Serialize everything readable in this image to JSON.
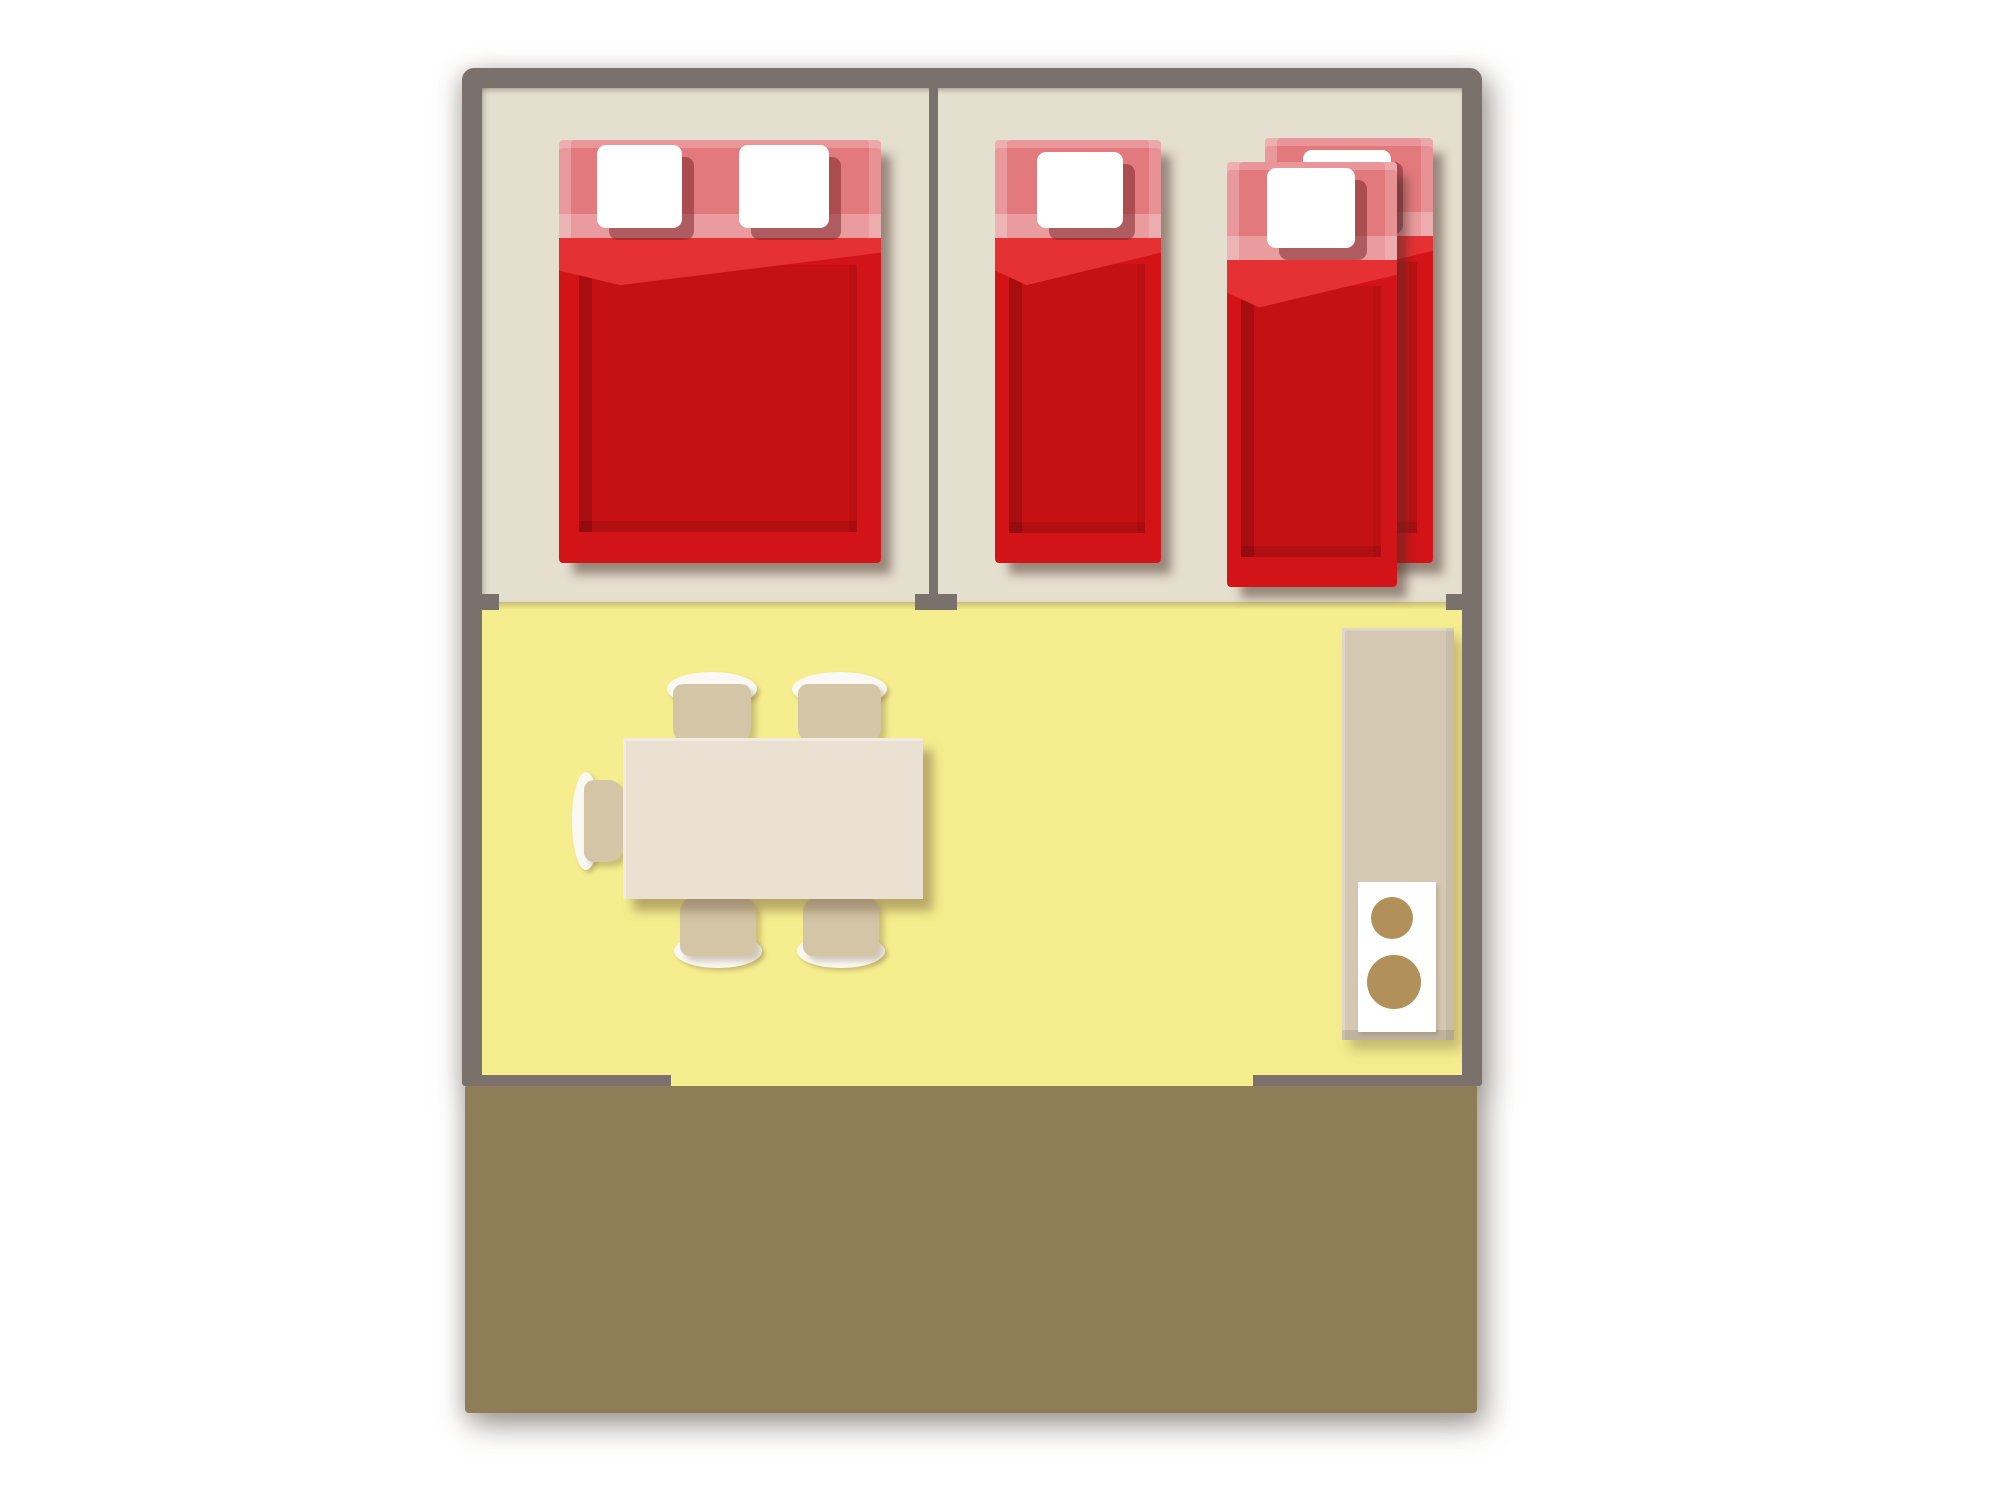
{
  "scene": {
    "type": "floor-plan",
    "description": "Top-down floor plan of a holiday mobile home: two bedrooms (beige floor), open living-dining area (yellow floor) with kitchen unit, and a wooden terrace (brown) at the bottom",
    "rooms": [
      {
        "name": "bedroom-1",
        "floor": "beige",
        "furniture": [
          "double-bed"
        ]
      },
      {
        "name": "bedroom-2",
        "floor": "beige",
        "furniture": [
          "single-bed",
          "single-bed",
          "single-bed"
        ]
      },
      {
        "name": "living-dining-area",
        "floor": "yellow",
        "furniture": [
          "dining-table",
          "chair-north-1",
          "chair-north-2",
          "chair-south-1",
          "chair-south-2",
          "chair-west",
          "kitchen-unit-with-two-burner-stove"
        ]
      },
      {
        "name": "terrace",
        "floor": "brown-wood",
        "furniture": []
      }
    ],
    "counts": {
      "double_beds": 1,
      "single_beds": 3,
      "pillows": 5,
      "chairs": 5,
      "tables": 1,
      "stove_burners": 2
    }
  },
  "colors": {
    "pageBg": "#ffffff",
    "wall": "#7a716c",
    "floorBedroom": "#e5dfd0",
    "floorLiving": "#f6ee8e",
    "terrace": "#8e7d56",
    "bedRed": "#d21419",
    "bedRedFold": "#e63134",
    "bedRedInner": "#c61114",
    "bedPink": "#e2797d",
    "pillow": "#ffffff",
    "pillowShadow": "rgba(125,40,45,0.55)",
    "tan": "#d4c5a6",
    "tableTop": "#eae1d3",
    "chairBack": "#faf8f2",
    "kitchenUnit": "#d5c8b2",
    "kitchenPanel": "#ffffff",
    "burner": "#b29059"
  }
}
